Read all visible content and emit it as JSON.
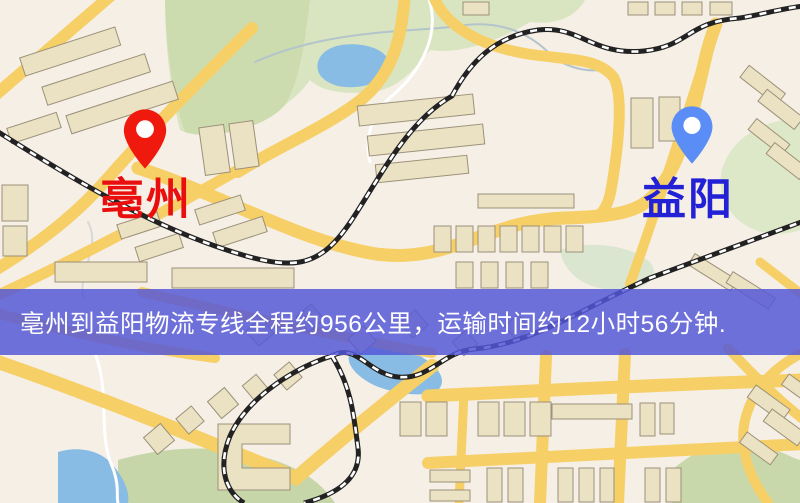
{
  "map": {
    "origin": {
      "label": "亳州",
      "pin_color": "#f0190e",
      "label_color": "#ea0f0f"
    },
    "destination": {
      "label": "益阳",
      "pin_color": "#5a8df5",
      "label_color": "#2321d6"
    },
    "banner": {
      "text": "亳州到益阳物流专线全程约956公里，运输时间约12小时56分钟.",
      "background_color": "#5457d8",
      "text_color": "#ffffff"
    },
    "route": {
      "origin_city": "亳州",
      "destination_city": "益阳",
      "distance_km": 956,
      "duration_text": "12小时56分钟"
    },
    "palette": {
      "map_background": "#f5efe6",
      "road": "#f6cf66",
      "park": "#d9e4c0",
      "water": "#88bce4",
      "building": "#ebe1c3",
      "railway": "#222222"
    }
  }
}
